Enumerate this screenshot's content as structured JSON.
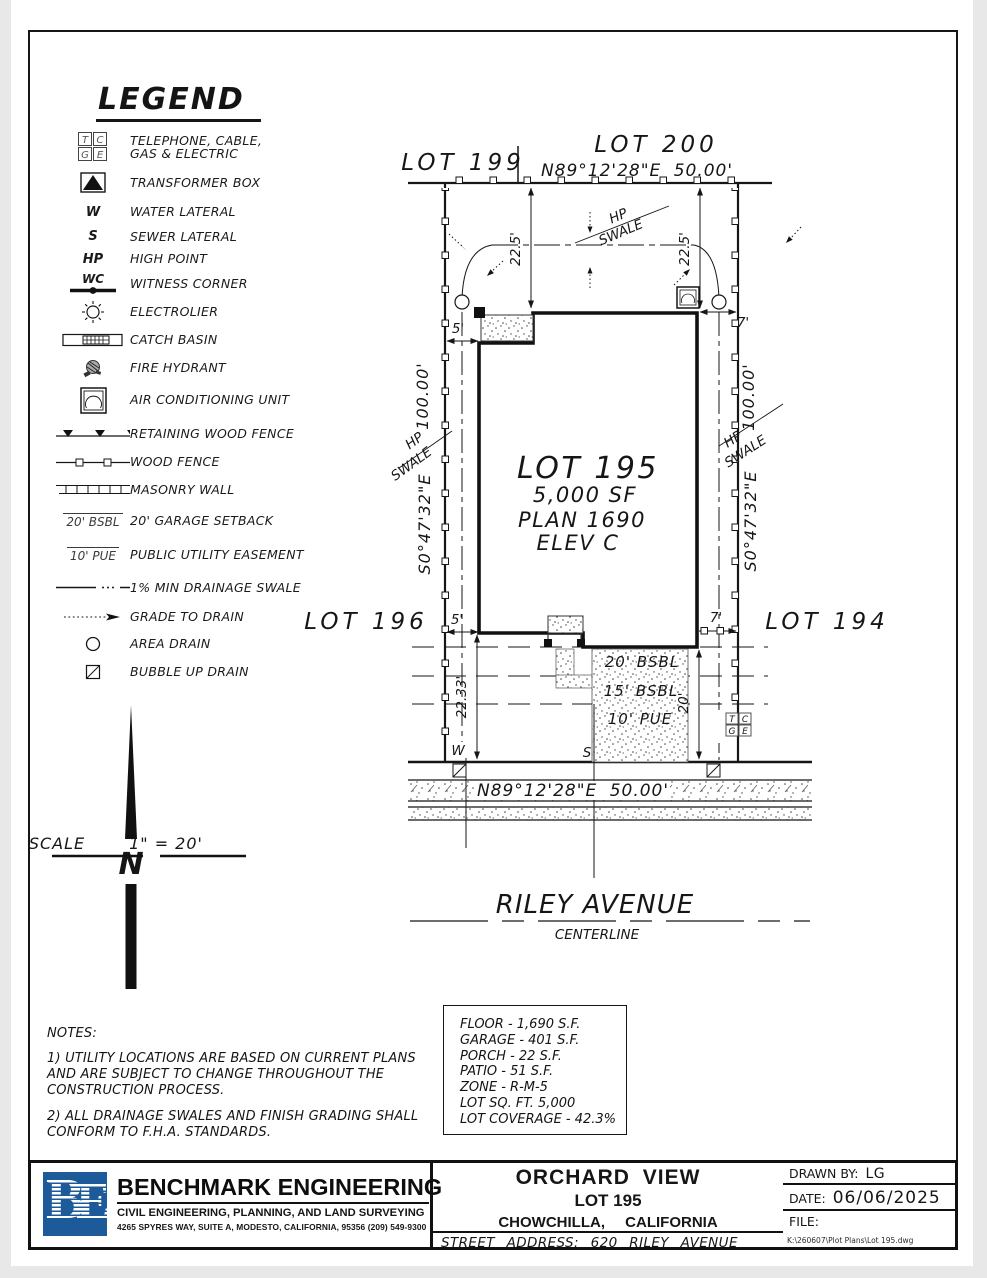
{
  "colors": {
    "ink": "#161616",
    "gray_label": "#8f8f8f",
    "logo_blue": "#1d5a99",
    "paper": "#ffffff"
  },
  "tcge": {
    "t": "T",
    "c": "C",
    "g": "G",
    "e": "E"
  },
  "legend": {
    "title": "LEGEND",
    "items": [
      {
        "symbol": "tcge-box",
        "label": "TELEPHONE, CABLE,",
        "label2": "GAS & ELECTRIC"
      },
      {
        "symbol": "transformer-box",
        "label": "TRANSFORMER BOX"
      },
      {
        "symbol_text": "W",
        "label": "WATER LATERAL"
      },
      {
        "symbol_text": "S",
        "label": "SEWER LATERAL"
      },
      {
        "symbol_text": "HP",
        "label": "HIGH POINT"
      },
      {
        "symbol_text": "WC",
        "label": "WITNESS CORNER"
      },
      {
        "symbol": "electrolier",
        "label": "ELECTROLIER"
      },
      {
        "symbol": "catch-basin",
        "label": "CATCH BASIN"
      },
      {
        "symbol": "fire-hydrant",
        "label": "FIRE HYDRANT"
      },
      {
        "symbol": "ac-unit",
        "label": "AIR CONDITIONING UNIT"
      },
      {
        "symbol": "retaining-wood-fence",
        "label": "RETAINING WOOD FENCE"
      },
      {
        "symbol": "wood-fence",
        "label": "WOOD FENCE"
      },
      {
        "symbol": "masonry-wall",
        "label": "MASONRY WALL"
      },
      {
        "symbol_text": "20' BSBL",
        "label": "20' GARAGE SETBACK"
      },
      {
        "symbol_text": "10' PUE",
        "label": "PUBLIC UTILITY EASEMENT"
      },
      {
        "symbol": "swale-line",
        "label": "1% MIN DRAINAGE SWALE"
      },
      {
        "symbol": "grade-arrow",
        "label": "GRADE TO DRAIN"
      },
      {
        "symbol": "area-drain",
        "label": "AREA DRAIN"
      },
      {
        "symbol": "bubble-up-drain",
        "label": "BUBBLE UP DRAIN"
      }
    ]
  },
  "site": {
    "lots": {
      "top_left": "LOT 199",
      "top_right": "LOT 200",
      "left": "LOT 196",
      "right": "LOT 194"
    },
    "bearings": {
      "rear": "N89°12'28\"E  50.00'",
      "front": "N89°12'28\"E  50.00'",
      "left_distance": "100.00'",
      "left_bearing": "S0°47'32\"E",
      "right_distance": "100.00'",
      "right_bearing": "S0°47'32\"E"
    },
    "house": {
      "lot": "LOT 195",
      "area": "5,000 SF",
      "plan": "PLAN 1690",
      "elevation": "ELEV C"
    },
    "dims": {
      "rear_left": "22.5'",
      "rear_right": "22.5'",
      "side_left_rear": "5'",
      "side_right_rear": "7'",
      "side_left_front": "5'",
      "side_right_front": "7'",
      "front_left": "22.33'",
      "front_right": "20'"
    },
    "setback_labels": {
      "garage": "20' BSBL",
      "house": "15' BSBL",
      "pue": "10' PUE"
    },
    "swale": {
      "hp": "HP",
      "swale": "SWALE"
    },
    "utilities": {
      "water": "W",
      "sewer": "S"
    },
    "street": {
      "name": "RILEY AVENUE",
      "centerline": "CENTERLINE"
    }
  },
  "north": {
    "letter": "N",
    "scale_label": "SCALE",
    "scale_value": "1\" = 20'"
  },
  "notes": {
    "lines": [
      "NOTES:",
      "1) UTILITY LOCATIONS ARE BASED ON CURRENT PLANS",
      "AND ARE SUBJECT TO CHANGE THROUGHOUT THE",
      "CONSTRUCTION PROCESS.",
      "2) ALL DRAINAGE SWALES AND FINISH GRADING SHALL",
      "CONFORM TO F.H.A. STANDARDS."
    ]
  },
  "stats": {
    "lines": [
      "FLOOR - 1,690 S.F.",
      "GARAGE - 401 S.F.",
      "PORCH - 22 S.F.",
      "PATIO - 51 S.F.",
      "ZONE - R-M-5",
      "LOT SQ. FT. 5,000",
      "LOT COVERAGE - 42.3%"
    ]
  },
  "titleblock": {
    "firm": {
      "name": "BENCHMARK ENGINEERING",
      "tagline": "CIVIL ENGINEERING, PLANNING, AND LAND SURVEYING",
      "address": "4265 SPYRES WAY, SUITE A, MODESTO, CALIFORNIA, 95356    (209) 549-9300",
      "logo_b": "B",
      "logo_e": "E"
    },
    "project": {
      "name": "ORCHARD VIEW",
      "lot": "LOT 195",
      "city": "CHOWCHILLA, CALIFORNIA",
      "street_address": "STREET ADDRESS: 620 RILEY AVENUE"
    },
    "meta": {
      "drawn_by_label": "DRAWN BY:",
      "drawn_by": "LG",
      "date_label": "DATE:",
      "date": "06/06/2025",
      "file_label": "FILE:",
      "file_path": "K:\\260607\\Plot Plans\\Lot 195.dwg"
    }
  }
}
